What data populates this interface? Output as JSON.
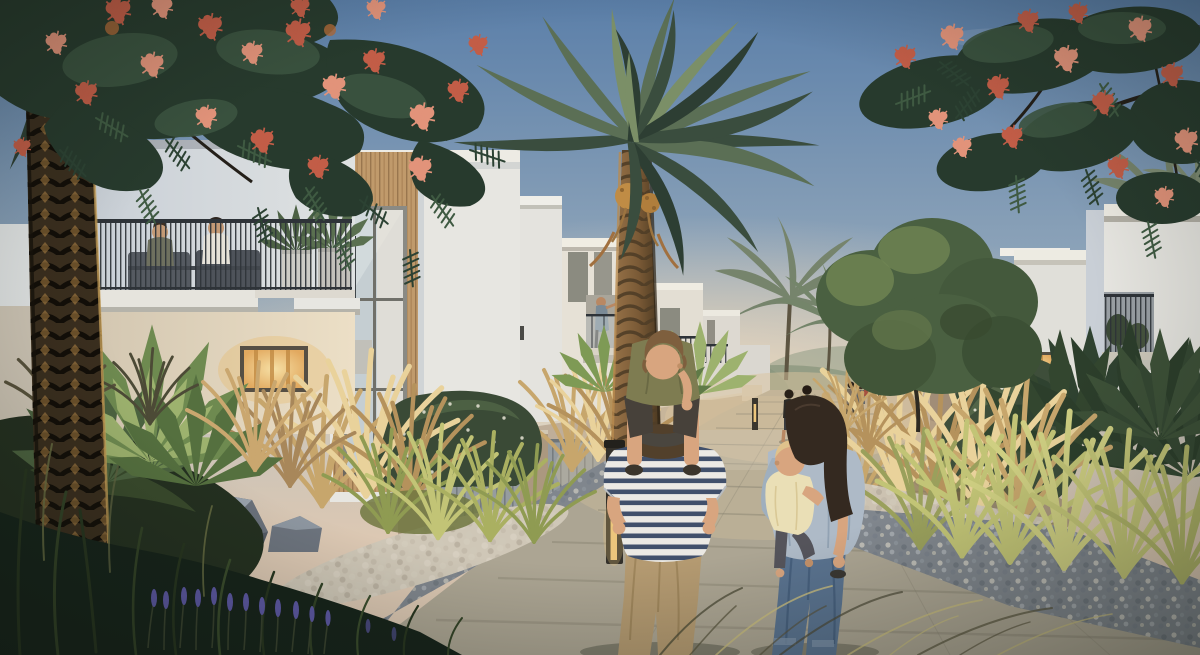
{
  "scene": {
    "description": "Dusk architectural rendering of a modern townhouse community: two rows of white two-storey villas with balconies flank a paved pedestrian walkway. A man carries a boy on his shoulders beside a woman holding a toddler; small groups of residents walk further down the path. A large date palm stands at the centre, a dark palm trunk and a flame tree with coral-red blossoms frame the top corners, and desert landscaping with golden grasses, rocks, gravel beds, lavender and bollard lights fills the foreground.",
    "elements": [
      {
        "name": "sky",
        "desc": "clear dusk sky, blue fading to warm cream at the horizon"
      },
      {
        "name": "left-townhouse-row",
        "desc": "4+ white villas receding; nearest has a balcony with two seated people, sofas and planters; second has a timber-clad bay with a tall window; a woman stands on a distant balcony"
      },
      {
        "name": "right-townhouse-row",
        "desc": "3+ white villas receding; nearest has a recessed balcony with plants and a warm lit window"
      },
      {
        "name": "center-date-palm",
        "desc": "tall date palm with full frond crown and golden date clusters"
      },
      {
        "name": "left-palm-trunk",
        "desc": "dark diamond-textured palm trunk framing the left edge"
      },
      {
        "name": "flame-trees",
        "desc": "royal-poinciana style branches with red puffball flowers across both top corners"
      },
      {
        "name": "walkway",
        "desc": "plank-paved central path with stone slabs and blue-grey gravel borders"
      },
      {
        "name": "family-foreground",
        "desc": "man in striped shirt with boy on shoulders; woman in light blue shirt and jeans carrying a toddler"
      },
      {
        "name": "distant-walkers",
        "desc": "three walkers mid-path and a small group near the vanishing point"
      },
      {
        "name": "balcony-people",
        "desc": "two people seated on the near-left balcony; one woman standing on a far balcony"
      },
      {
        "name": "landscaping",
        "desc": "golden ornamental grasses, white-speckled shrubs, fan palms, boulders, white cobbles, lavender spikes, backlit grass wisps"
      },
      {
        "name": "bollard-lights",
        "desc": "2 lit timber bollards beside the path, plus one distant"
      }
    ],
    "counts": {
      "bollards": 3,
      "foreground-people": 4,
      "distant-walkers": 5,
      "balcony-people": 3
    }
  },
  "palette": {
    "skyTop": "#5b7fa9",
    "skyMid": "#8ba2b8",
    "skyLow": "#c3c1b9",
    "horizon": "#dcc8b3",
    "glow": "#eedabd",
    "bldg": "#e7e6e1",
    "bldgLit": "#efe9dc",
    "bldgShade": "#c9cfd6",
    "bldgShade2": "#b0b8c1",
    "bldgWarm": "#e8ddc8",
    "bldgDist": "#dad7d0",
    "wood": "#c09a6b",
    "woodDark": "#99764e",
    "rail": "#2e3338",
    "glass": "#c5ced2",
    "winGlow": "#e2a95f",
    "winGlowHi": "#f6dfa4",
    "trunkDark": "#3a2e1e",
    "trunkMid": "#815f39",
    "trunkGold": "#c3914b",
    "frondDk": "#3a4d3e",
    "frondMd": "#5b6f55",
    "frondLt": "#7b8f67",
    "frondDk2": "#2d3e33",
    "flame": "#273a2d",
    "flameMd": "#3c5440",
    "branch": "#241f19",
    "flower": "#c25d47",
    "flowerLt": "#e2937a",
    "treeGr": "#4a6041",
    "treeGrLt": "#6f8452",
    "goldGrass": "#c7a66c",
    "goldGrassLt": "#e9d29b",
    "litGrass": "#c2c476",
    "greenGrass": "#6f7c49",
    "bedDk": "#243020",
    "bedDk2": "#16231a",
    "gravel": "#80868d",
    "cobble": "#cfc7b7",
    "slab": "#c5beae",
    "plank": "#aca593",
    "joint": "#85806f",
    "pathWarm": "#d9c49e",
    "wall": "#bfae99",
    "wallDk": "#a18d77",
    "slat": "#969c9f",
    "rock": "#535a64",
    "rockLt": "#99a2ac",
    "lavender": "#5e59a6",
    "skin": "#d8a57f",
    "manPants": "#b49a71",
    "manStripe": "#41506b",
    "manHair": "#52402b",
    "boyShirt": "#7e7c51",
    "boyShorts": "#47413a",
    "boyHair": "#7e5f3e",
    "womanShirt": "#aebac7",
    "womanJeans": "#5a7390",
    "womanHair": "#342920",
    "toddlerTop": "#eadfb6",
    "toddlerPants": "#55545b",
    "toddlerHair": "#dfc28c",
    "bollard": "#33302a",
    "bollardGlow": "#edc67c"
  }
}
